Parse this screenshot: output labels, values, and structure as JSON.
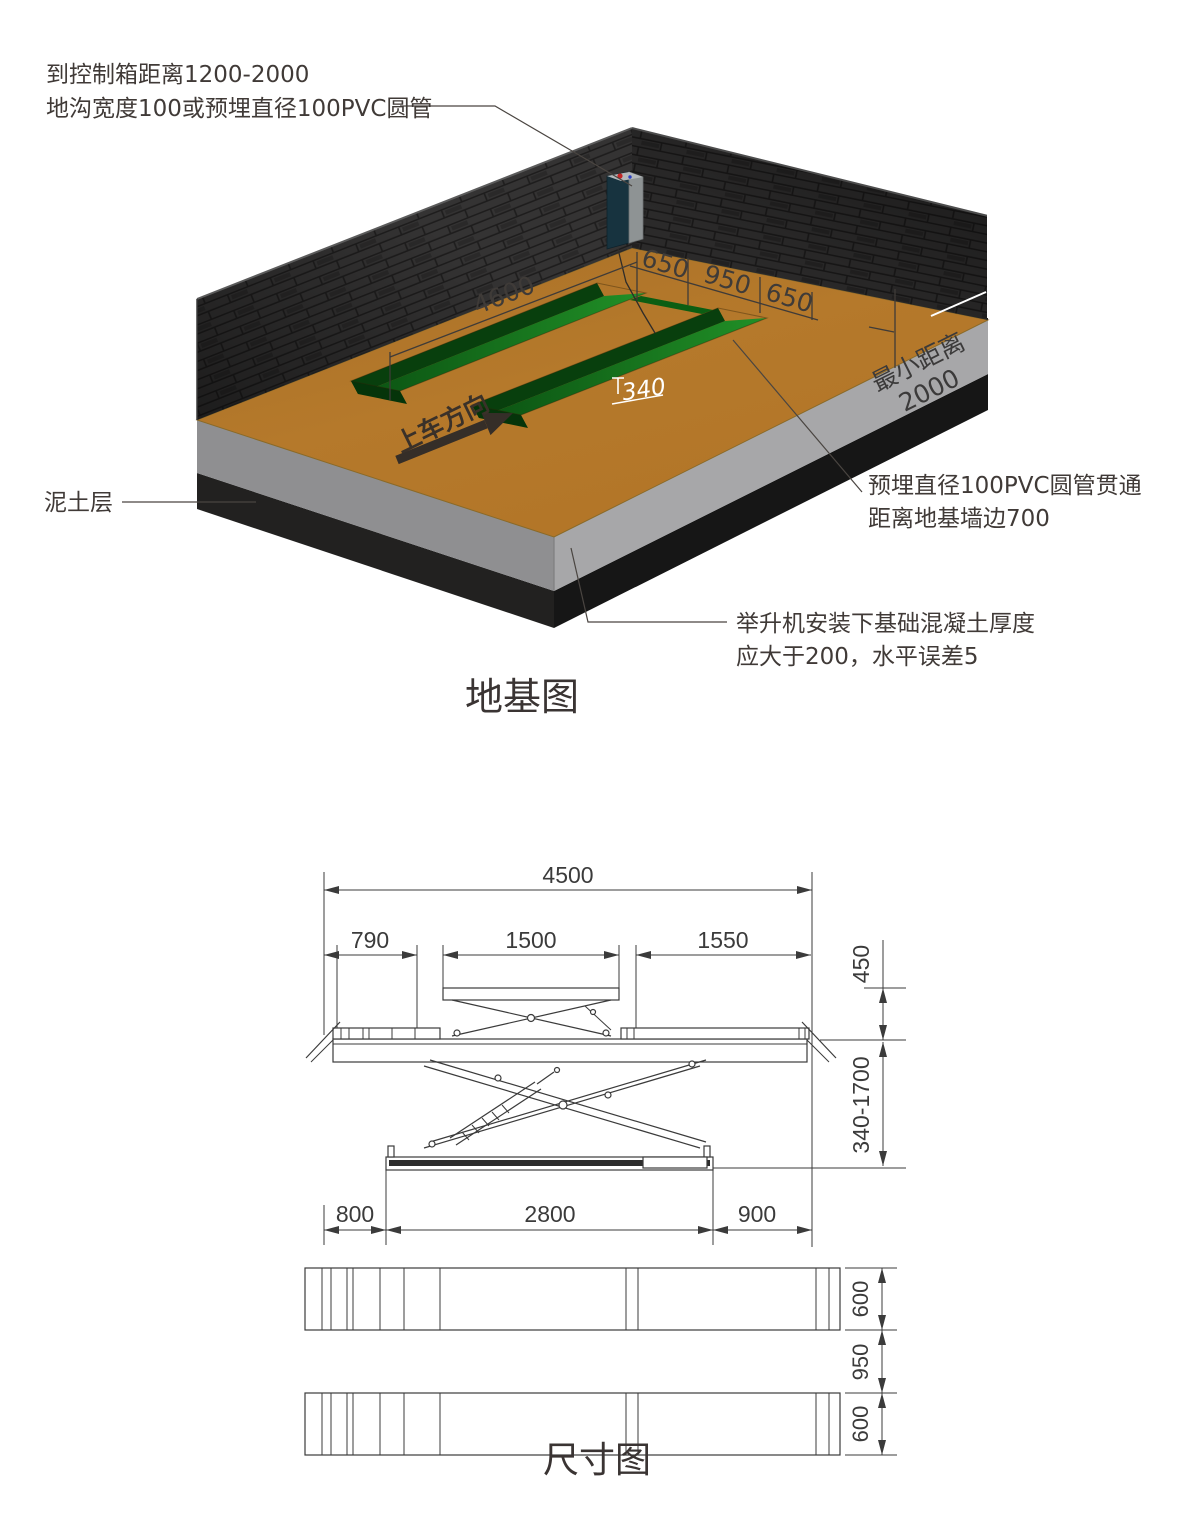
{
  "foundation": {
    "title": "地基图",
    "annotations": {
      "control_box": {
        "line1": "到控制箱距离1200-2000",
        "line2": "地沟宽度100或预埋直径100PVC圆管"
      },
      "soil_layer": "泥土层",
      "pvc_pipe": {
        "line1": "预埋直径100PVC圆管贯通",
        "line2": "距离地基墙边700"
      },
      "concrete": {
        "line1": "举升机安装下基础混凝土厚度",
        "line2": "应大于200，水平误差5"
      }
    },
    "labels": {
      "drive_direction": "上车方向",
      "min_distance_line1": "最小距离",
      "min_distance_line2": "2000"
    },
    "dims": {
      "pit_length": "4600",
      "pit_width_left": "650",
      "pit_gap": "950",
      "pit_width_right": "650",
      "pit_depth": "340"
    }
  },
  "dimension_drawing": {
    "title": "尺寸图",
    "dims": {
      "overall_length": "4500",
      "left_offset": "790",
      "table_length": "1500",
      "right_cover": "1550",
      "table_height": "450",
      "lift_height_range": "340-1700",
      "base_left_offset": "800",
      "base_length": "2800",
      "base_right_offset": "900",
      "platform_width_top": "600",
      "platform_gap": "950",
      "platform_width_bottom": "600"
    }
  },
  "colors": {
    "floor_brown": "#b5792b",
    "pit_green": "#17771e",
    "wall_dark": "#2e2d2d",
    "concrete_gray": "#9c9c9e",
    "soil_black": "#1d1d1d",
    "drawing_line": "#3b3b3b",
    "control_box_teal": "#17333f"
  }
}
